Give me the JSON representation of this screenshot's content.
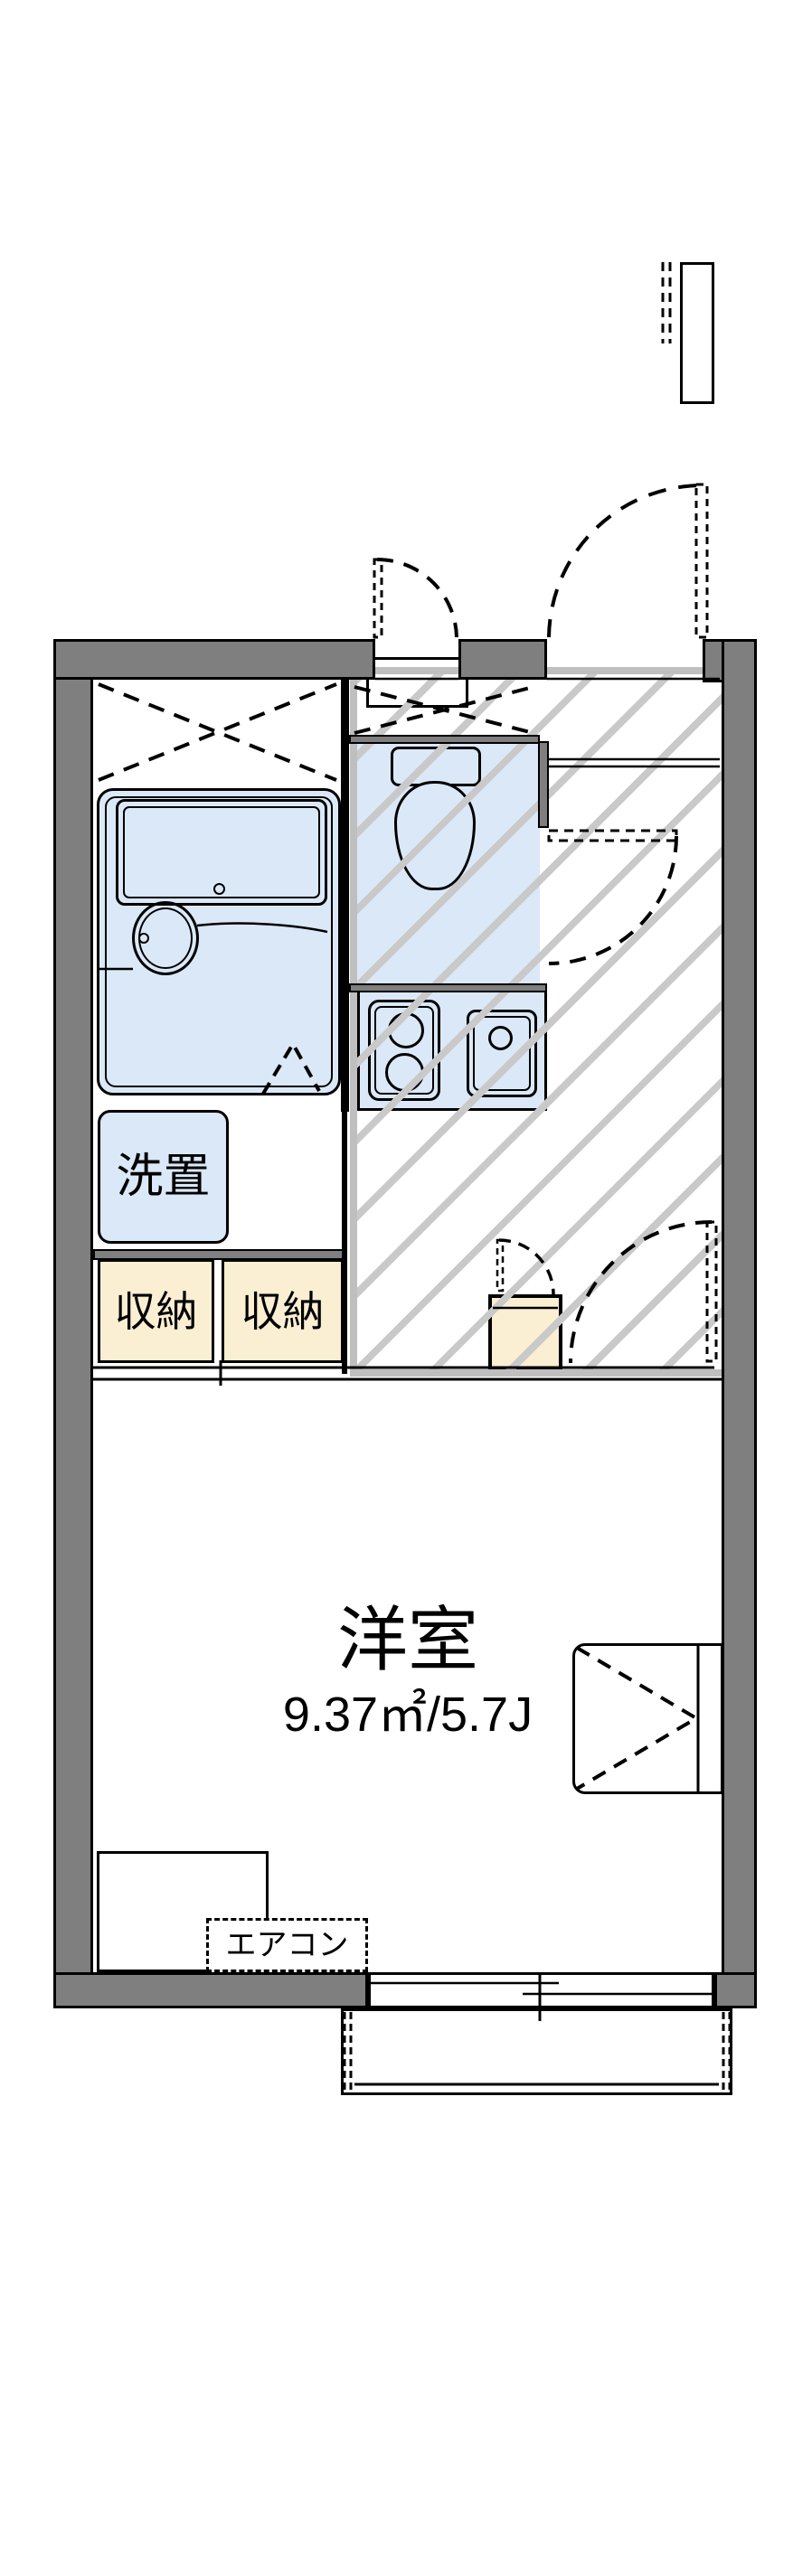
{
  "floorplan": {
    "labels": {
      "washer_area": "洗置",
      "storage_a": "収納",
      "storage_b": "収納",
      "room_name": "洋室",
      "room_area": "9.37㎡/5.7J",
      "aircon": "エアコン"
    },
    "colors": {
      "wall_gray": "#7f7f7f",
      "fixture_blue": "#dbe8f8",
      "storage_cream": "#faeed3",
      "hatch_silver": "#c9c9c9",
      "line_black": "#000000"
    }
  }
}
